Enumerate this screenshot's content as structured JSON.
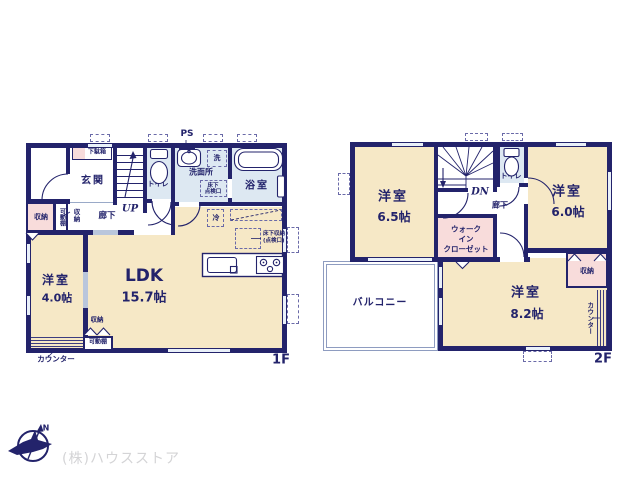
{
  "colors": {
    "wall_navy": "#23236b",
    "room_floor_cream": "#f6e8c6",
    "storage_pink": "#f8dcdb",
    "wet_area_blue": "#dde8f2",
    "window_light": "#e9f0f9",
    "balcony_line_gray": "#8e9cc0",
    "company_text_gray": "#d4d4d6"
  },
  "floor1": {
    "floor_label": "1F",
    "entrance": "玄関",
    "shoe_cabinet": "下駄箱",
    "toilet": "トイレ",
    "ps": "PS",
    "washer": "洗",
    "washroom": "洗面所",
    "underfloor_check_l1": "床下",
    "underfloor_check_l2": "点検口",
    "bath": "浴室",
    "up": "UP",
    "storage": "収納",
    "movable_shelf": "可動棚",
    "hallway": "廊下",
    "fridge": "冷",
    "underfloor_storage_l1": "床下収納",
    "underfloor_storage_l2": "(点検口)",
    "western_room_name": "洋室",
    "western_room_size": "4.0帖",
    "ldk_name": "LDK",
    "ldk_size": "15.7帖",
    "counter": "カウンター"
  },
  "floor2": {
    "floor_label": "2F",
    "room65_name": "洋室",
    "room65_size": "6.5帖",
    "room60_name": "洋室",
    "room60_size": "6.0帖",
    "room82_name": "洋室",
    "room82_size": "8.2帖",
    "dn": "DN",
    "hallway": "廊下",
    "toilet": "トイレ",
    "wic_l1": "ウォーク",
    "wic_l2": "イン",
    "wic_l3": "クローゼット",
    "balcony": "バルコニー",
    "storage": "収納",
    "counter": "カウンター"
  },
  "footer": {
    "company": "(株)ハウスストア",
    "compass_n": "N"
  }
}
